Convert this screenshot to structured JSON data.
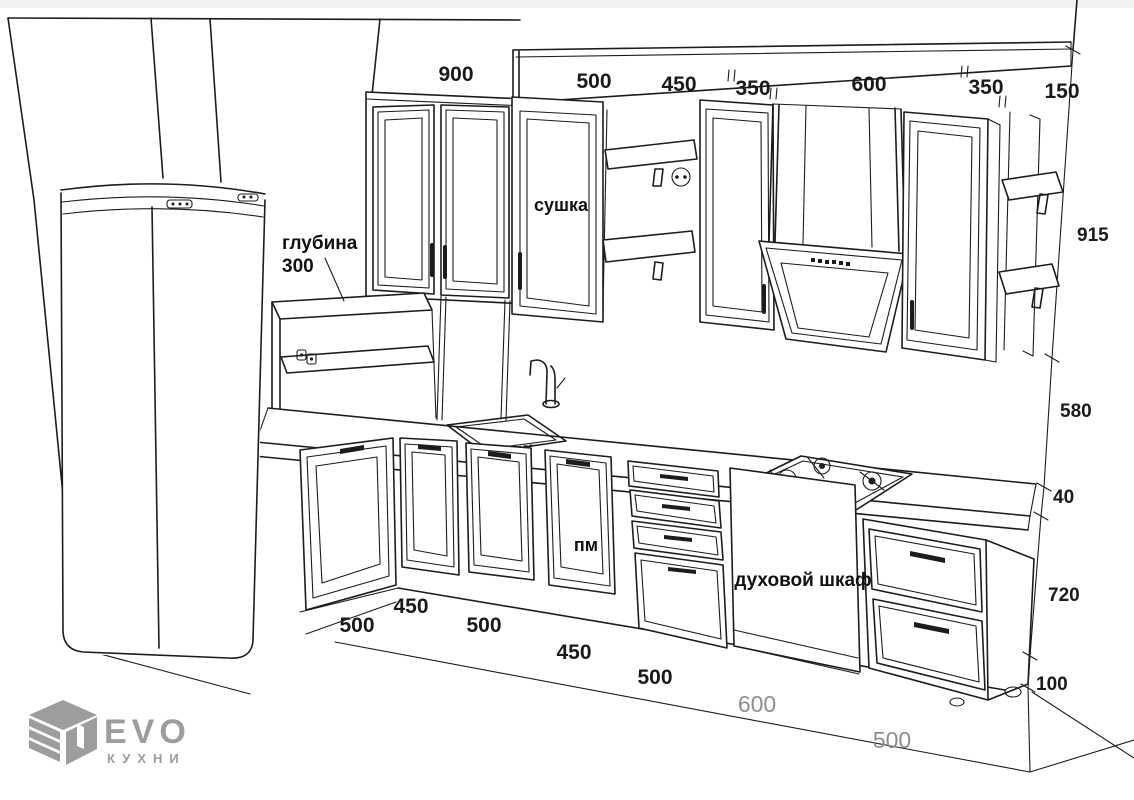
{
  "dims": {
    "top": [
      "900",
      "500",
      "450",
      "350",
      "600",
      "350",
      "150"
    ],
    "right": [
      "915",
      "580",
      "40",
      "720",
      "100"
    ],
    "bottom": [
      "500",
      "450",
      "500",
      "450",
      "500"
    ],
    "floor": [
      "600",
      "500"
    ]
  },
  "annotations": {
    "depth_label": "глубина",
    "depth_value": "300",
    "dryer_cabinet": "сушка",
    "dishwasher": "пм",
    "oven_cabinet": "духовой шкаф"
  },
  "logo": {
    "brand": "EVO",
    "subtitle": "КУХНИ"
  },
  "colors": {
    "line": "#1c1c1c",
    "dim_text": "#1a1a1a",
    "floor_dim_text": "#8d8d8d",
    "logo_gray": "#9d9d9d",
    "background": "#ffffff"
  }
}
